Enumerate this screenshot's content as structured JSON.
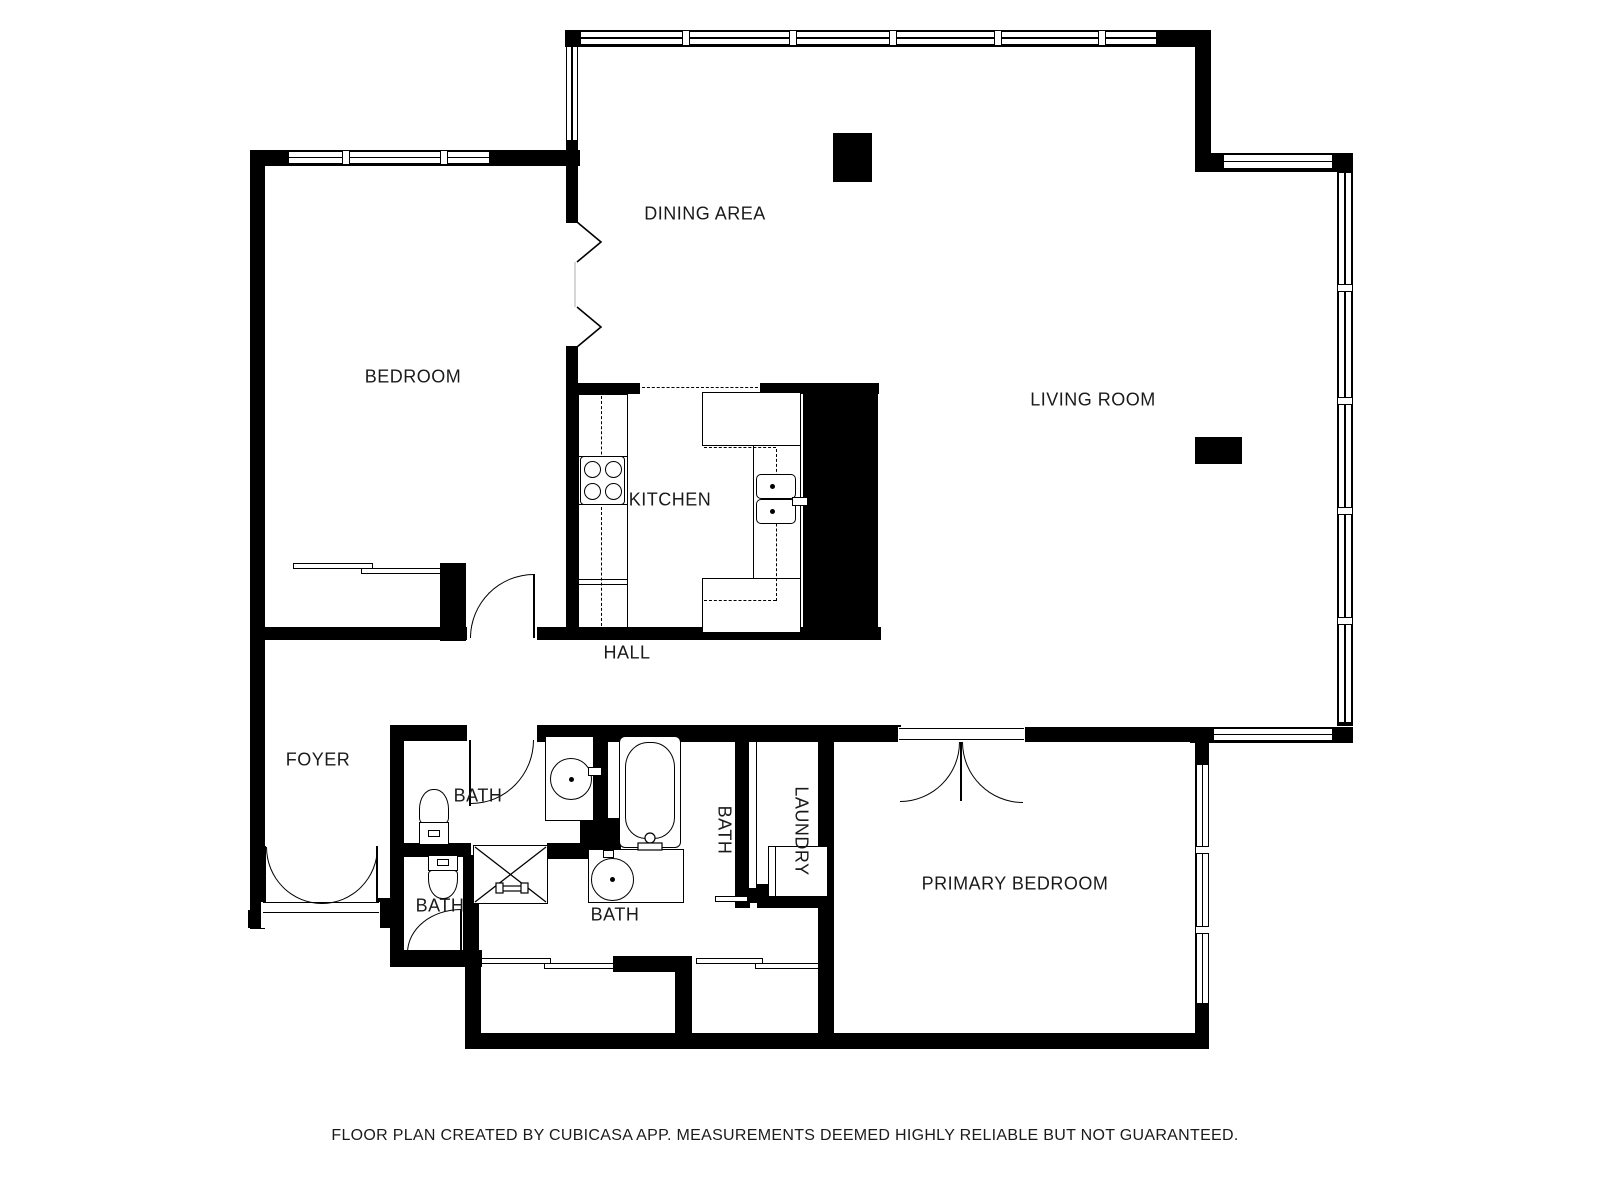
{
  "meta": {
    "document_type": "floor-plan",
    "creator_app": "CubiCasa",
    "disclaimer": "FLOOR PLAN CREATED BY CUBICASA APP. MEASUREMENTS DEEMED HIGHLY RELIABLE BUT NOT GUARANTEED."
  },
  "colors": {
    "wall": "#000000",
    "background": "#ffffff",
    "label_text": "#1a1a1a"
  },
  "rooms": [
    {
      "label": "DINING AREA"
    },
    {
      "label": "BEDROOM"
    },
    {
      "label": "LIVING ROOM"
    },
    {
      "label": "KITCHEN"
    },
    {
      "label": "HALL"
    },
    {
      "label": "FOYER"
    },
    {
      "label": "BATH"
    },
    {
      "label": "BATH"
    },
    {
      "label": "BATH"
    },
    {
      "label": "BATH"
    },
    {
      "label": "LAUNDRY"
    },
    {
      "label": "PRIMARY BEDROOM"
    }
  ],
  "fixtures": [
    "stove",
    "kitchen-counter",
    "kitchen-sink",
    "refrigerator-counter",
    "bathtub",
    "shower",
    "toilet",
    "toilet",
    "washer",
    "round-sink",
    "round-sink",
    "entry-double-door",
    "french-double-door",
    "sliding-closet-door",
    "window",
    "wall-opening"
  ]
}
